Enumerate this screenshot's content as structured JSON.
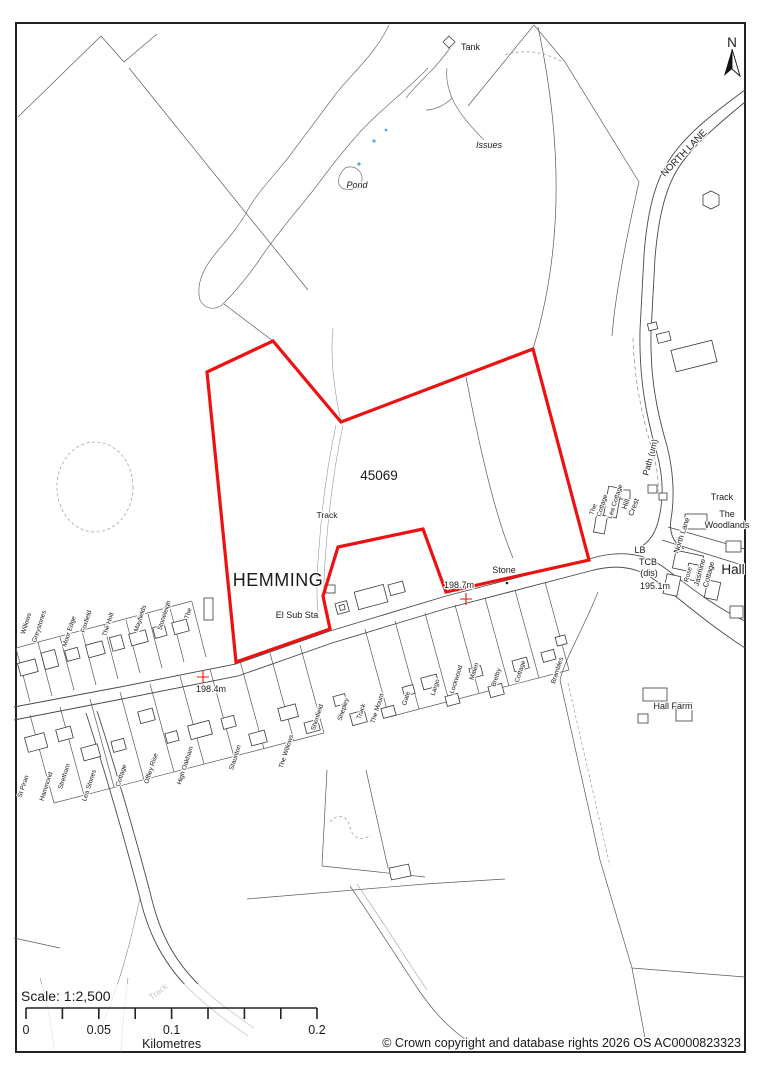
{
  "map_info": {
    "type": "Ordnance Survey site location plan",
    "boundary_color": "#ee1111",
    "scale_ratio": "1:2,500"
  },
  "site": {
    "parcel_number": "45069",
    "site_label": "HEMMING"
  },
  "north_arrow_label": "N",
  "features": {
    "tank": "Tank",
    "issues": "Issues",
    "pond": "Pond",
    "north_lane_major": "NORTH LANE",
    "north_lane_minor": "North Lane",
    "path_um": "Path (um)",
    "track_ne": "Track",
    "track_mid": "Track",
    "track_garden": "Track",
    "track_sw": "Track",
    "el_sub_sta": "El Sub Sta",
    "stone": "Stone",
    "lb": "LB",
    "tcb_line1": "TCB",
    "tcb_line2": "(dis)",
    "spot_height_195": "195.1m",
    "spot_height_1987": "198.7m",
    "spot_height_1984": "198.4m",
    "woodlands_line1": "The",
    "woodlands_line2": "Woodlands",
    "hall": "Hall",
    "hall_farm": "Hall Farm",
    "jasmine_line1": "Jasmine",
    "jasmine_line2": "Cottage",
    "rose": "Rose",
    "hill_crest_line1": "Hill",
    "hill_crest_line2": "Crest",
    "lea_cottage": "Lea Cottage",
    "cottage_east": "Cottage",
    "the_east": "The"
  },
  "houses_north": [
    "Willows",
    "Greystones",
    "Moor Edge",
    "Foxfield",
    "The Holt",
    "Mayfields",
    "Stoneleigh",
    "The"
  ],
  "houses_south": [
    "St Piran",
    "Hammond",
    "Stretham",
    "Lea Stones",
    "Cottage",
    "Offley Rise",
    "High Oakham",
    "Staunton",
    "The Willows",
    "Shenfield",
    "Shepley",
    "The Mount",
    "Gate",
    "Largo",
    "Lockwood",
    "Malen",
    "Bretby",
    "Cottage",
    "Brambles"
  ],
  "scale_bar": {
    "title": "Scale: 1:2,500",
    "ticks": [
      "0",
      "0.05",
      "0.1",
      "0.2"
    ],
    "unit": "Kilometres"
  },
  "attribution": "© Crown copyright and database rights 2026 OS AC0000823323"
}
